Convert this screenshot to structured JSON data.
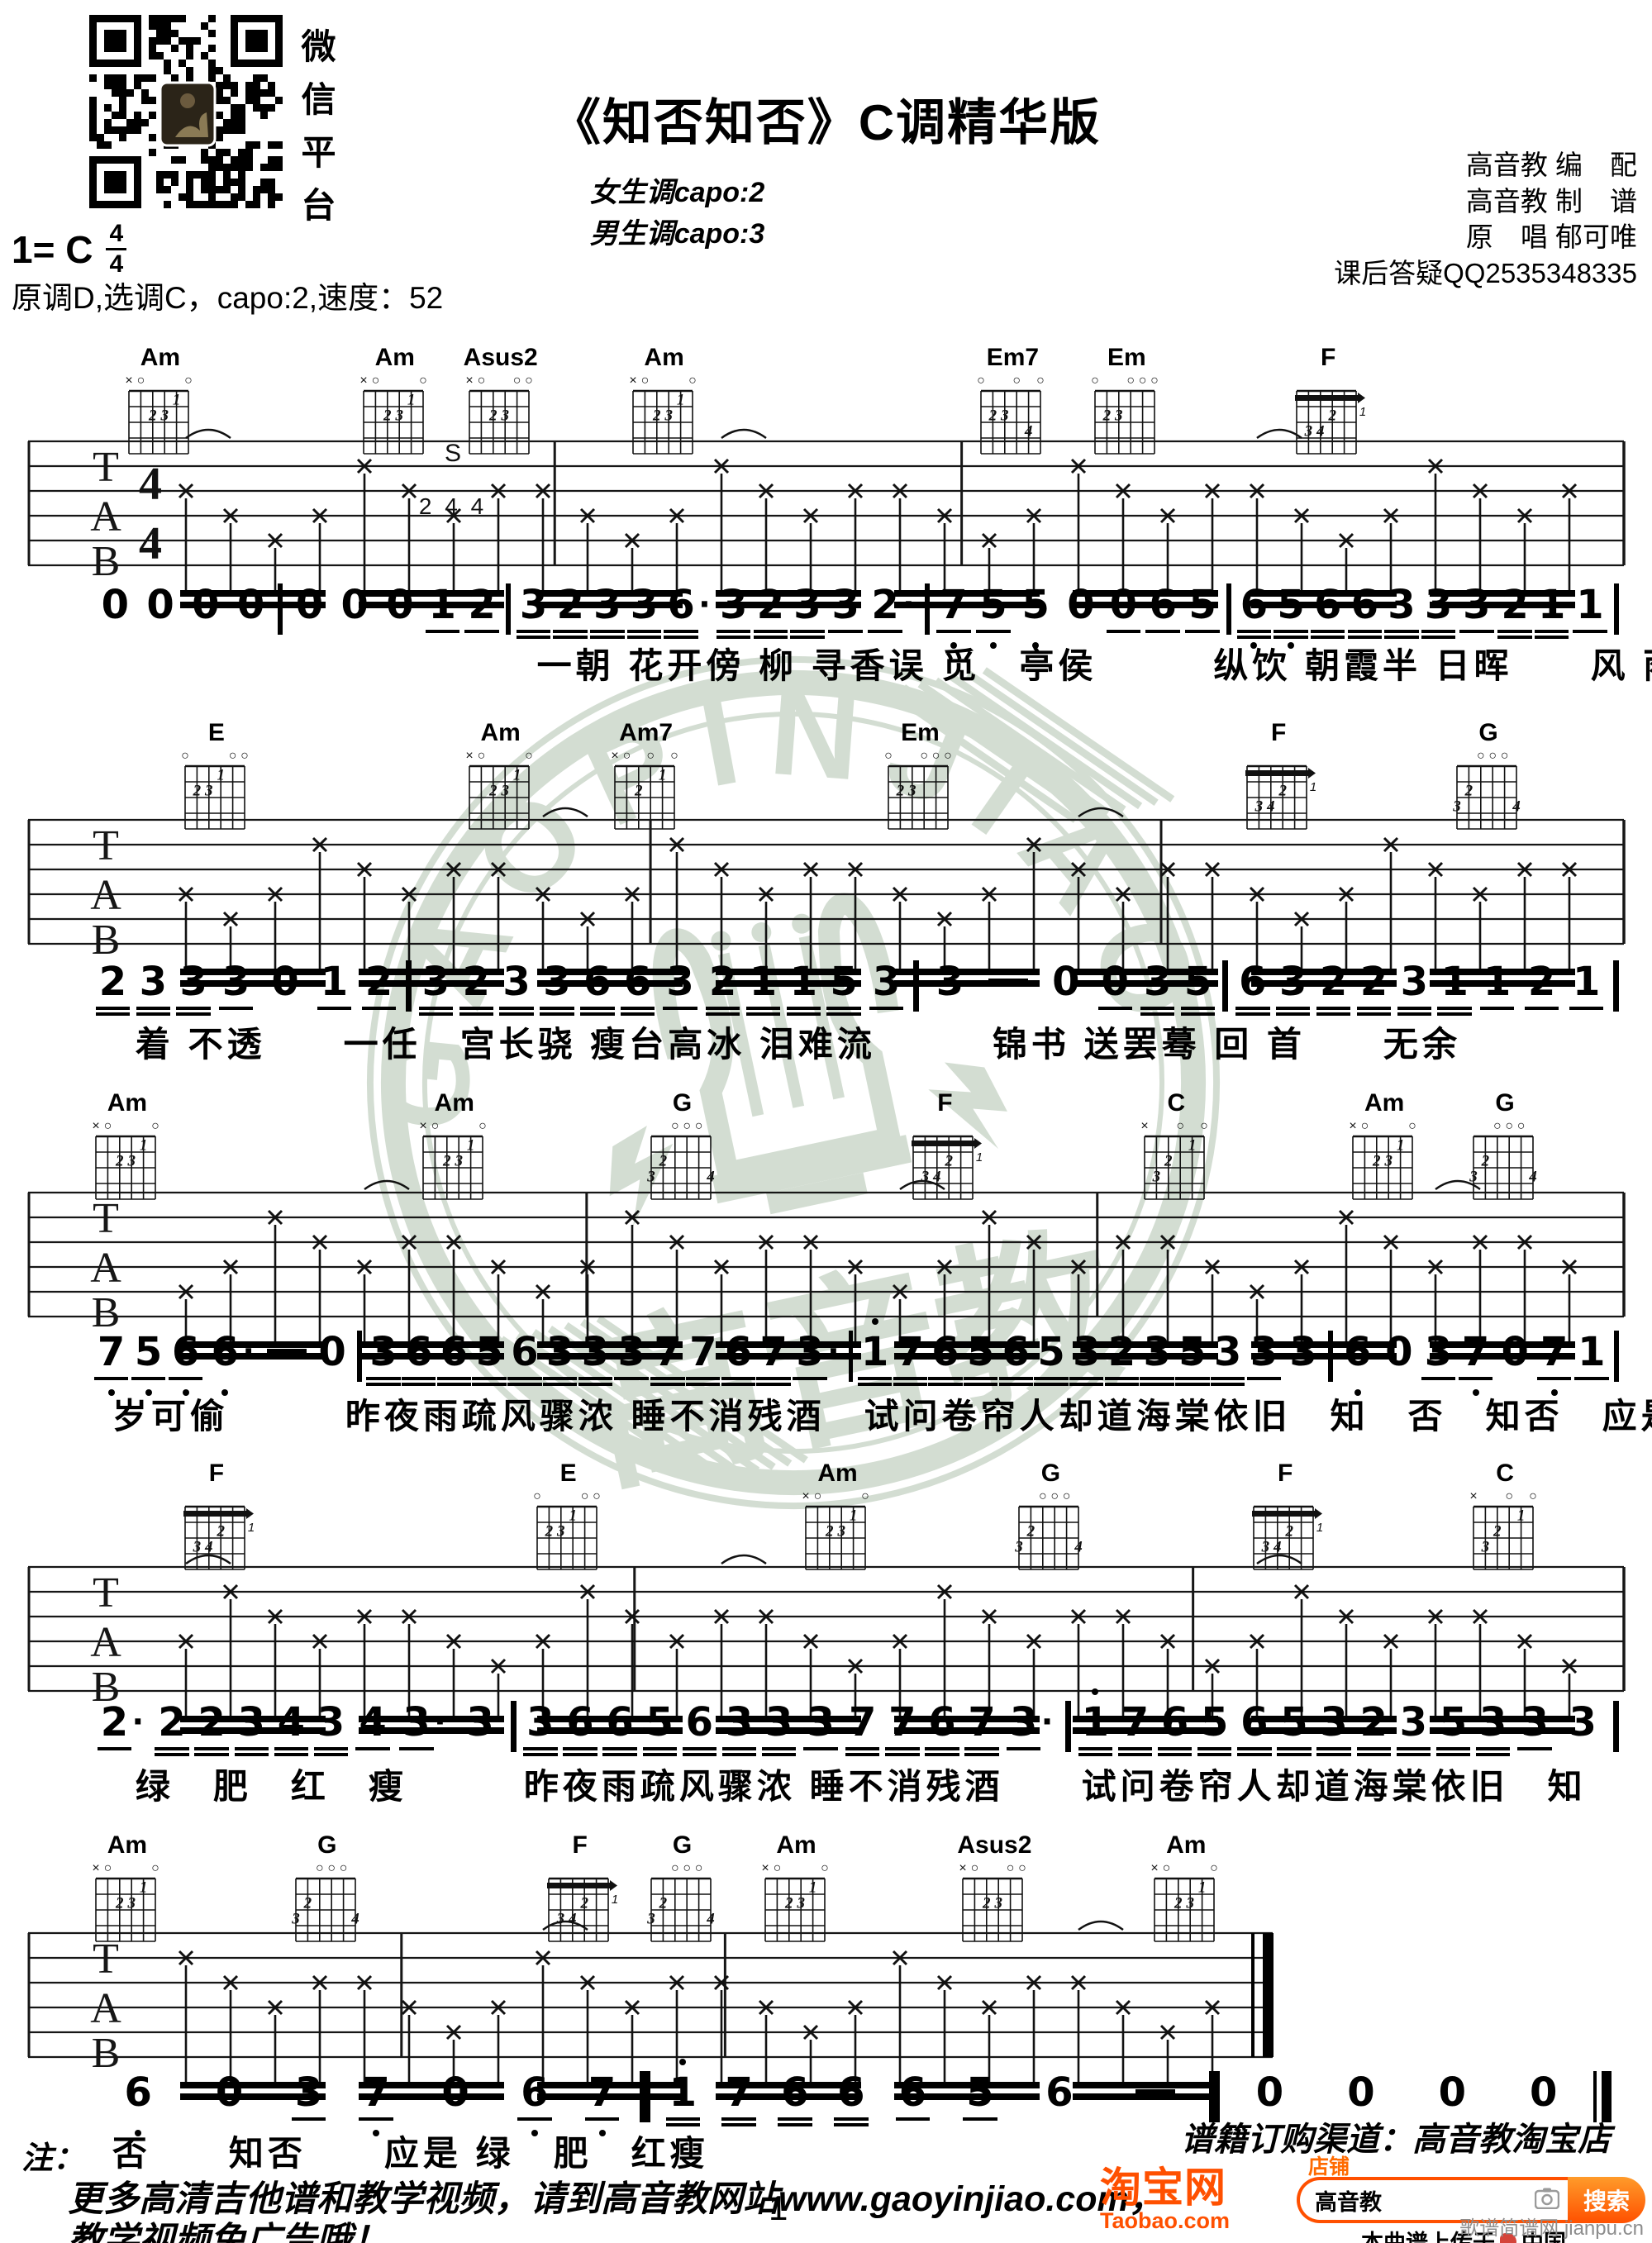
{
  "header": {
    "qr_caption": "微信平台",
    "key_line": "1= C",
    "time_top": "4",
    "time_bottom": "4",
    "title": "《知否知否》C调精华版",
    "capo_female": "女生调capo:2",
    "capo_male": "男生调capo:3",
    "credits": [
      "高音教 编　配",
      "高音教 制　谱",
      "原　唱 郁可唯",
      "课后答疑QQ2535348335"
    ],
    "tuning_line": "原调D,选调C，capo:2,速度：52"
  },
  "chord_shapes": {
    "Am": {
      "markers": [
        "x",
        "o",
        "",
        "",
        "",
        "o"
      ],
      "fingers": [
        [
          3,
          2,
          "2"
        ],
        [
          4,
          2,
          "3"
        ],
        [
          5,
          1,
          "1"
        ]
      ]
    },
    "Asus2": {
      "markers": [
        "x",
        "o",
        "",
        "",
        "o",
        "o"
      ],
      "fingers": [
        [
          3,
          2,
          "2"
        ],
        [
          4,
          2,
          "3"
        ]
      ]
    },
    "Em7": {
      "markers": [
        "o",
        "",
        "",
        "o",
        "",
        "o"
      ],
      "fingers": [
        [
          2,
          2,
          "2"
        ],
        [
          3,
          2,
          "3"
        ],
        [
          5,
          3,
          "4"
        ]
      ]
    },
    "Em": {
      "markers": [
        "o",
        "",
        "",
        "o",
        "o",
        "o"
      ],
      "fingers": [
        [
          2,
          2,
          "2"
        ],
        [
          3,
          2,
          "3"
        ]
      ]
    },
    "F": {
      "markers": [
        "",
        "",
        "",
        "",
        "",
        ""
      ],
      "fingers": [
        [
          2,
          3,
          "3"
        ],
        [
          3,
          3,
          "4"
        ],
        [
          4,
          2,
          "2"
        ]
      ],
      "barre": {
        "fret": 1,
        "label": "1"
      }
    },
    "E": {
      "markers": [
        "o",
        "",
        "",
        "",
        "o",
        "o"
      ],
      "fingers": [
        [
          2,
          2,
          "2"
        ],
        [
          3,
          2,
          "3"
        ],
        [
          4,
          1,
          "1"
        ]
      ]
    },
    "Am7": {
      "markers": [
        "x",
        "o",
        "",
        "o",
        "",
        "o"
      ],
      "fingers": [
        [
          3,
          2,
          "2"
        ],
        [
          5,
          1,
          "1"
        ]
      ]
    },
    "G": {
      "markers": [
        "",
        "",
        "o",
        "o",
        "o",
        ""
      ],
      "fingers": [
        [
          1,
          3,
          "3"
        ],
        [
          2,
          2,
          "2"
        ],
        [
          6,
          3,
          "4"
        ]
      ]
    },
    "C": {
      "markers": [
        "x",
        "",
        "",
        "o",
        "",
        "o"
      ],
      "fingers": [
        [
          2,
          3,
          "3"
        ],
        [
          3,
          2,
          "2"
        ],
        [
          5,
          1,
          "1"
        ]
      ]
    }
  },
  "systems": [
    {
      "chords": [
        {
          "name": "Am",
          "x": 0.097
        },
        {
          "name": "Am",
          "x": 0.239
        },
        {
          "name": "Asus2",
          "x": 0.303
        },
        {
          "name": "Am",
          "x": 0.402
        },
        {
          "name": "Em7",
          "x": 0.613
        },
        {
          "name": "Em",
          "x": 0.682
        },
        {
          "name": "F",
          "x": 0.804
        }
      ],
      "annotation": {
        "s": "S",
        "nums": "2 4 4"
      },
      "melody": [
        "0",
        "0",
        "0",
        "0",
        "|",
        "0",
        "0",
        "0",
        "1_",
        "2_",
        "|",
        "3=",
        "2=",
        "3=",
        "3=",
        "6.=",
        "3=",
        "2=",
        "3=",
        "3_",
        "2._",
        "|",
        "7v_",
        "5v_",
        "5v",
        "0",
        "0_",
        "6_",
        "5_",
        "|",
        "6v=",
        "5v=",
        "6=",
        "6=",
        "3=",
        "3=",
        "3_",
        "2=",
        "1=",
        "1_",
        "|"
      ],
      "lyrics": "一朝 花开傍 柳 寻香误 觅　亭侯　　　纵饮 朝霞半 日晖　　风 雨",
      "lyrics_indent": 0.325
    },
    {
      "chords": [
        {
          "name": "E",
          "x": 0.131
        },
        {
          "name": "Am",
          "x": 0.303
        },
        {
          "name": "Am7",
          "x": 0.391
        },
        {
          "name": "Em",
          "x": 0.557
        },
        {
          "name": "F",
          "x": 0.774
        },
        {
          "name": "G",
          "x": 0.901
        }
      ],
      "melody": [
        "2=",
        "3=",
        "3=",
        "3_",
        "0",
        "1_",
        "2_",
        "|",
        "3=",
        "2=",
        "3=",
        "3=",
        "6=",
        "6=",
        "3_",
        "2=",
        "1=",
        "1=",
        "5=",
        "3_",
        "|",
        "3",
        "—",
        "0",
        "0_",
        "3=",
        "5=",
        "|",
        "6=",
        "3=",
        "2=",
        "2=",
        "3=",
        "1=",
        "1_",
        "2_",
        "1_",
        "|"
      ],
      "lyrics": "着 不透　　一任　宫长骁 瘦台高冰 泪难流　　　锦书 送罢蓦 回 首　　无余",
      "lyrics_indent": 0.082
    },
    {
      "chords": [
        {
          "name": "Am",
          "x": 0.077
        },
        {
          "name": "Am",
          "x": 0.275
        },
        {
          "name": "G",
          "x": 0.413
        },
        {
          "name": "F",
          "x": 0.572
        },
        {
          "name": "C",
          "x": 0.712
        },
        {
          "name": "Am",
          "x": 0.838
        },
        {
          "name": "G",
          "x": 0.911
        }
      ],
      "melody": [
        "7v_",
        "5v_",
        "6v_",
        "6v.",
        "—",
        "0",
        "|",
        "3=",
        "6=",
        "6=",
        "5=",
        "6=",
        "3=",
        "3=",
        "3_",
        "7=",
        "7=",
        "6=",
        "7=",
        "3._",
        "|",
        "1^=",
        "7=",
        "6=",
        "5=",
        "6=",
        "5=",
        "3=",
        "2=",
        "3=",
        "5=",
        "3=",
        "3_",
        "3",
        "|",
        "6v",
        "0",
        "3_",
        "7v_",
        "0",
        "7v_",
        "1_",
        "|"
      ],
      "lyrics": "岁可偷　　　昨夜雨疏风骤浓 睡不消残酒　试问卷帘人却道海棠依旧　知　否　知否　应是",
      "lyrics_indent": 0.068
    },
    {
      "chords": [
        {
          "name": "F",
          "x": 0.131
        },
        {
          "name": "E",
          "x": 0.344
        },
        {
          "name": "Am",
          "x": 0.507
        },
        {
          "name": "G",
          "x": 0.636
        },
        {
          "name": "F",
          "x": 0.778
        },
        {
          "name": "C",
          "x": 0.911
        }
      ],
      "melody": [
        "2._",
        "2=",
        "2=",
        "3=",
        "4=",
        "3=",
        "4_",
        "3._",
        "3",
        "|",
        "3=",
        "6=",
        "6=",
        "5=",
        "6=",
        "3=",
        "3=",
        "3_",
        "7=",
        "7=",
        "6=",
        "7=",
        "3._",
        "|",
        "1^=",
        "7=",
        "6=",
        "5=",
        "6=",
        "5=",
        "3=",
        "2=",
        "3=",
        "5=",
        "3=",
        "3_",
        "3",
        "|"
      ],
      "lyrics": "绿　肥　红　瘦　　　昨夜雨疏风骤浓 睡不消残酒　　试问卷帘人却道海棠依旧　知",
      "lyrics_indent": 0.082
    },
    {
      "chords": [
        {
          "name": "Am",
          "x": 0.077
        },
        {
          "name": "G",
          "x": 0.198
        },
        {
          "name": "F",
          "x": 0.351
        },
        {
          "name": "G",
          "x": 0.413
        },
        {
          "name": "Am",
          "x": 0.482
        },
        {
          "name": "Asus2",
          "x": 0.602
        },
        {
          "name": "Am",
          "x": 0.718
        }
      ],
      "melody": [
        "6v",
        "0",
        "3_",
        "7v_",
        "0",
        "6v_",
        "7v_",
        "|",
        "1^=",
        "7=",
        "6=",
        "6=",
        "6_",
        "5_",
        "6",
        "—",
        "|",
        "0",
        "0",
        "0",
        "0",
        "‖"
      ],
      "lyrics": "否　　知否　　应是 绿　肥　红瘦",
      "lyrics_indent": 0.068
    }
  ],
  "watermark": {
    "ring_text": "GAOPINJIAO",
    "cn_text": "高音教",
    "color": "#9fb69d"
  },
  "footer": {
    "note_label": "注：",
    "note_line1": "更多高清吉他谱和教学视频，请到高音教网站www.gaoyinjiao.com，",
    "note_line2": "教学视频免广告哦！",
    "page_number": "1",
    "order_channel": "谱籍订购渠道：高音教淘宝店",
    "taobao": {
      "logo": "淘宝网",
      "logo_sub": "Taobao.com",
      "shop_label": "店铺",
      "search_value": "高音教",
      "search_button": "搜索",
      "upload_note": "本曲谱上传于",
      "partner": "中国",
      "orange": "#ff5000"
    },
    "site_watermark": "歌谱简谱网 jianpu.cn"
  }
}
